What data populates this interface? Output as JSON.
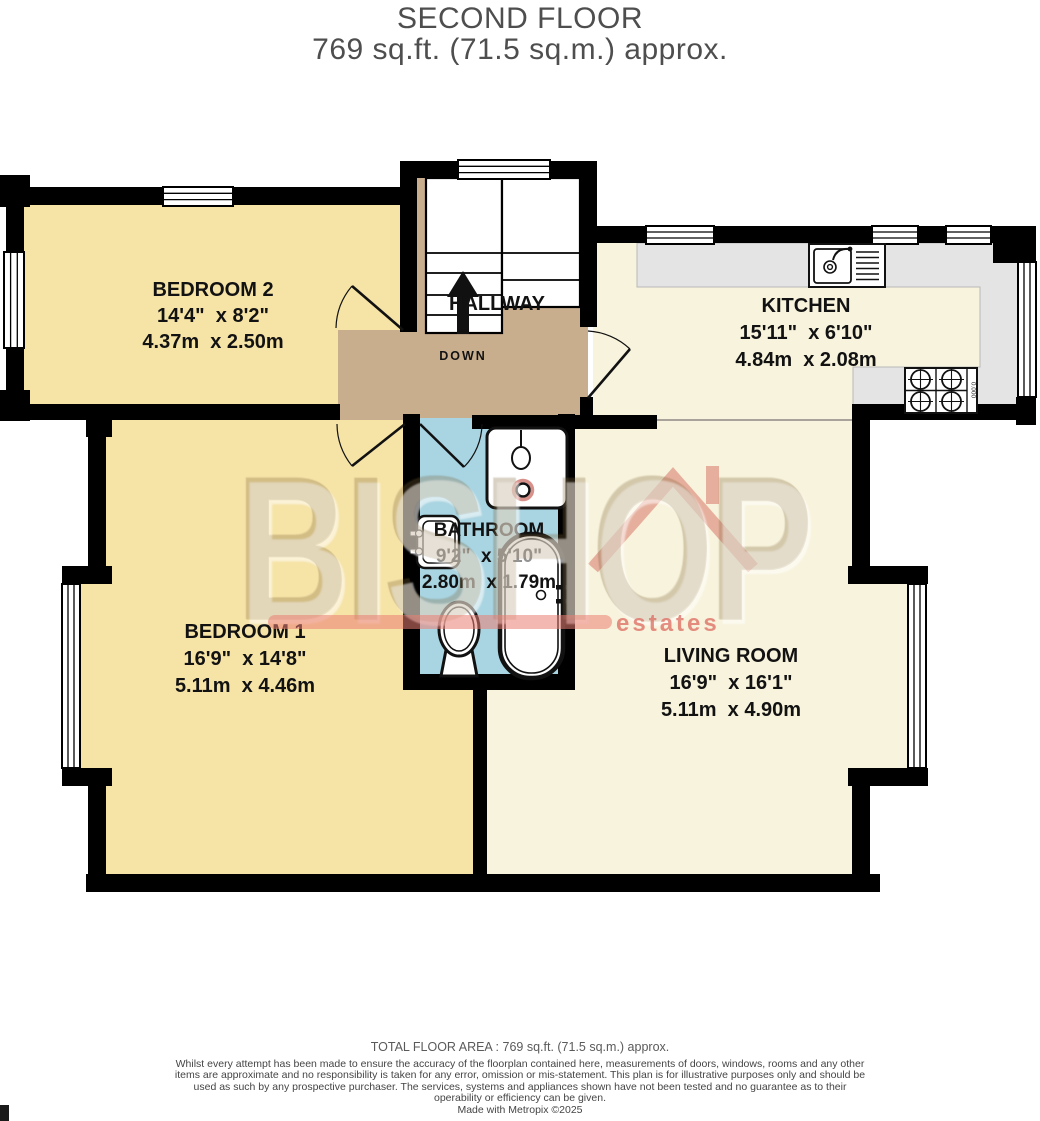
{
  "title": {
    "line1": "SECOND FLOOR",
    "line2": "769 sq.ft. (71.5 sq.m.) approx."
  },
  "rooms": {
    "bedroom2": {
      "name": "BEDROOM 2",
      "imperial": "14'4\"  x 8'2\"",
      "metric": "4.37m  x 2.50m"
    },
    "kitchen": {
      "name": "KITCHEN",
      "imperial": "15'11\"  x 6'10\"",
      "metric": "4.84m  x 2.08m"
    },
    "bathroom": {
      "name": "BATHROOM",
      "imperial": "9'2\"  x 5'10\"",
      "metric": "2.80m  x 1.79m"
    },
    "bedroom1": {
      "name": "BEDROOM 1",
      "imperial": "16'9\"  x 14'8\"",
      "metric": "5.11m  x 4.46m"
    },
    "living_room": {
      "name": "LIVING ROOM",
      "imperial": "16'9\"  x 16'1\"",
      "metric": "5.11m  x 4.90m"
    },
    "hallway": {
      "name": "HALLWAY",
      "stairs_label": "DOWN"
    }
  },
  "fixtures": {
    "hob_label": "0.000"
  },
  "watermark": {
    "name": "BISHOP",
    "tagline": "estates",
    "accent_color": "#d9675e"
  },
  "colors": {
    "bedroom_floor": "#f6e3a6",
    "living_kitchen_floor": "#f8f3dc",
    "hallway_floor": "#c9ae8e",
    "bathroom_floor": "#a9d4e1",
    "wall": "#000000",
    "counter": "#e4e4e4"
  },
  "footer": {
    "total_area": "TOTAL FLOOR AREA : 769 sq.ft. (71.5 sq.m.) approx.",
    "disclaimer": "Whilst every attempt has been made to ensure the accuracy of the floorplan contained here, measurements of doors, windows, rooms and any other items are approximate and no responsibility is taken for any error, omission or mis-statement. This plan is for illustrative purposes only and should be used as such by any prospective purchaser. The services, systems and appliances shown have not been tested and no guarantee as to their operability or efficiency can be given.",
    "credit": "Made with Metropix ©2025"
  }
}
